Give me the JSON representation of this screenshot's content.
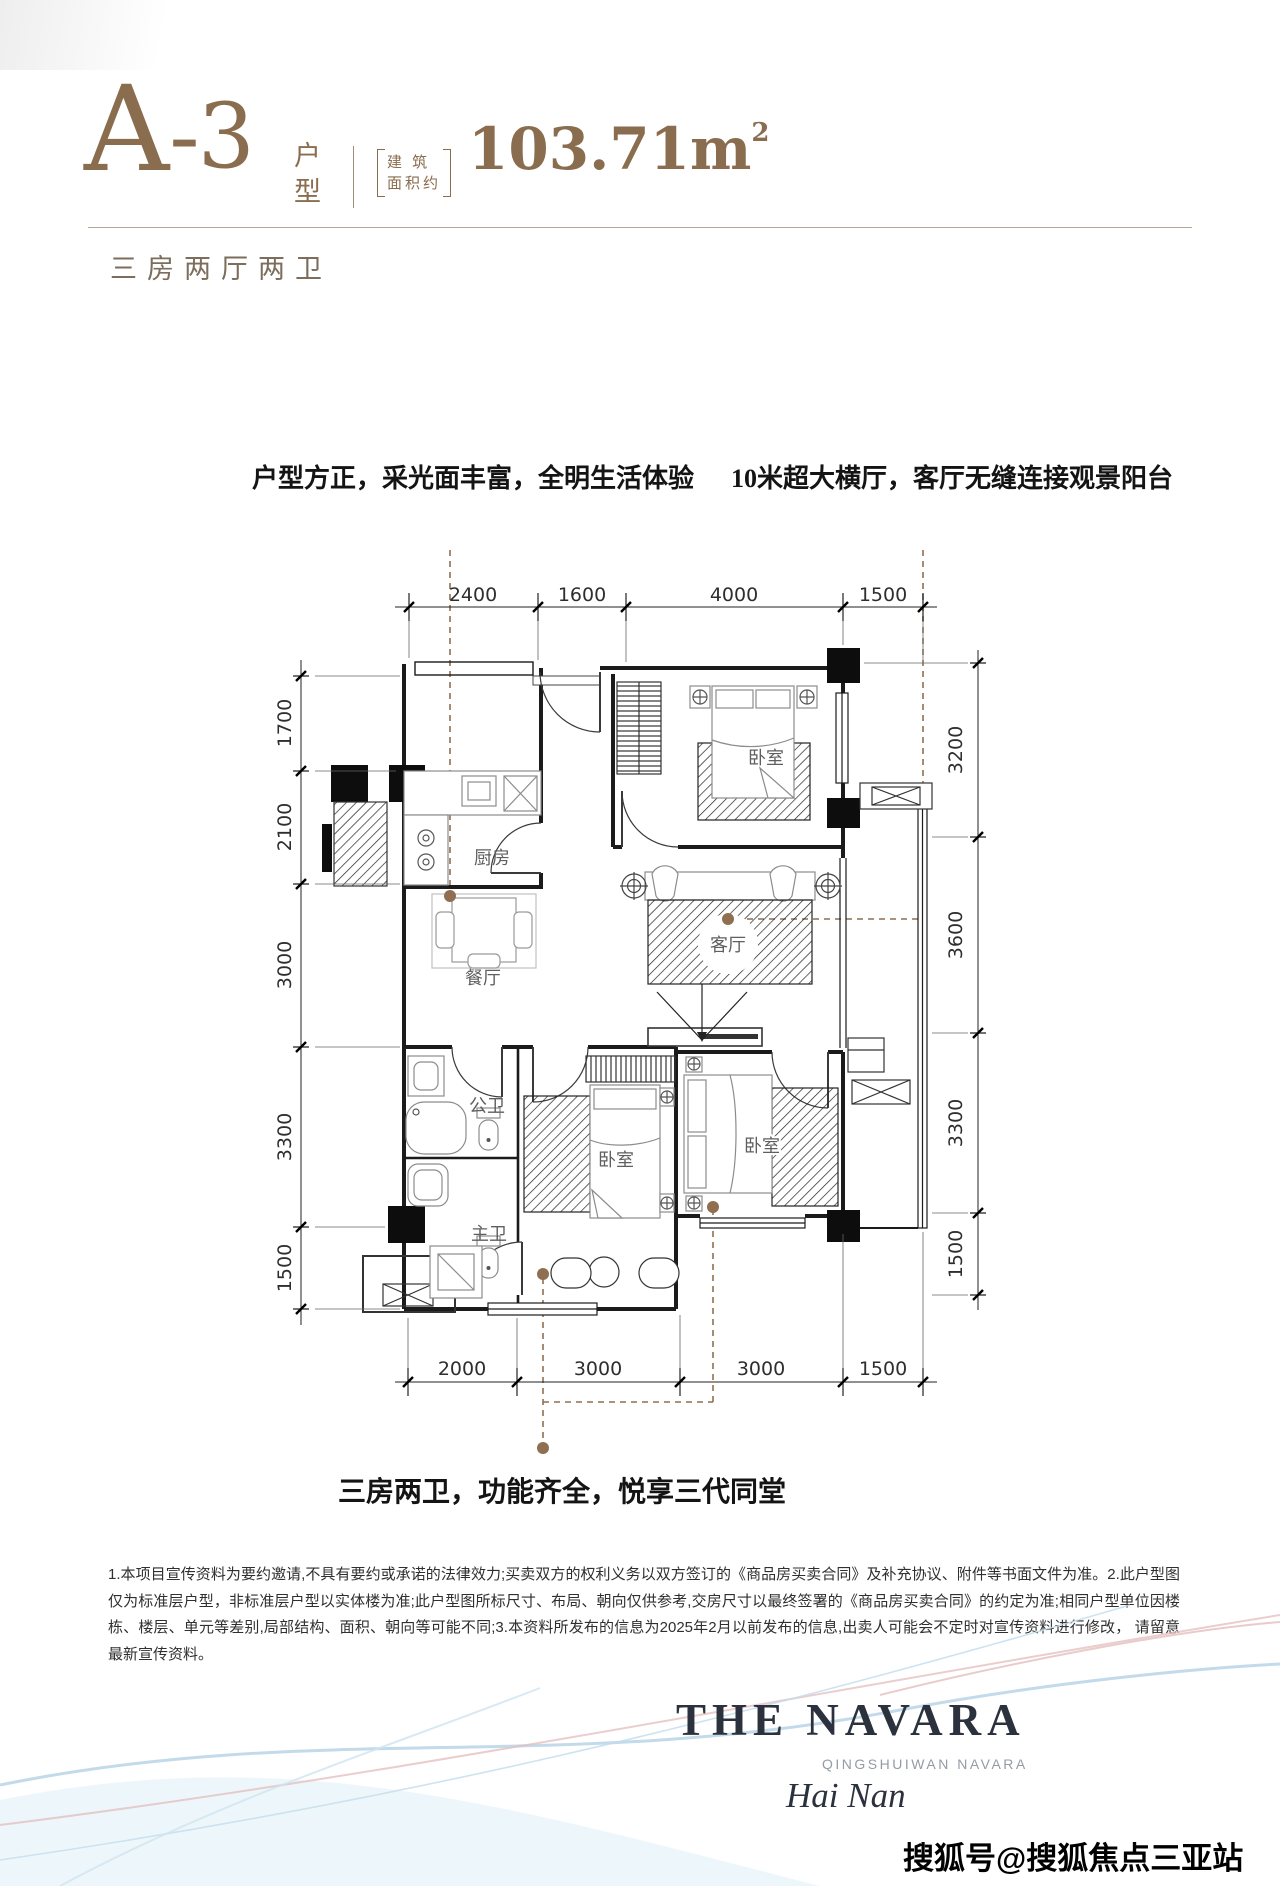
{
  "colors": {
    "accent": "#8a6d4e",
    "leader_brown": "#8f6f4f",
    "logo_navy": "#2b323d",
    "wave_blue": "#b9d4e6",
    "wave_pink": "#e3bcbc"
  },
  "header": {
    "unit_letter": "A",
    "unit_number": "-3",
    "type_top": "户",
    "type_bottom": "型",
    "area_label_line1": "建 筑",
    "area_label_line2": "面积约",
    "area_value": "103.71m",
    "area_sup": "2",
    "subtitle": "三房两厅两卫"
  },
  "annotations": {
    "left": "户型方正，采光面丰富，全明生活体验",
    "right": "10米超大横厅，客厅无缝连接观景阳台",
    "bottom": "三房两卫，功能齐全，悦享三代同堂"
  },
  "floorplan": {
    "labels": {
      "kitchen": "厨房",
      "dining": "餐厅",
      "bedroom_top": "卧室",
      "living": "客厅",
      "bath_public": "公卫",
      "bath_master": "主卫",
      "bedroom_mid": "卧室",
      "bedroom_right": "卧室"
    },
    "dims": {
      "top": [
        "2400",
        "1600",
        "4000",
        "1500"
      ],
      "left": [
        "1700",
        "2100",
        "3000",
        "3300",
        "1500"
      ],
      "right": [
        "3200",
        "3600",
        "3300",
        "1500"
      ],
      "bottom": [
        "2000",
        "3000",
        "3000",
        "1500"
      ]
    }
  },
  "disclaimer": {
    "text": "1.本项目宣传资料为要约邀请,不具有要约或承诺的法律效力;买卖双方的权利义务以双方签订的《商品房买卖合同》及补充协议、附件等书面文件为准。2.此户型图仅为标准层户型，非标准层户型以实体楼为准;此户型图所标尺寸、布局、朝向仅供参考,交房尺寸以最终签署的《商品房买卖合同》的约定为准;相同户型单位因楼栋、楼层、单元等差别,局部结构、面积、朝向等可能不同;3.本资料所发布的信息为2025年2月以前发布的信息,出卖人可能会不定时对宣传资料进行修改， 请留意最新宣传资料。"
  },
  "logo": {
    "title": "THE NAVARA",
    "subtitle": "QINGSHUIWAN NAVARA",
    "location": "Hai Nan"
  },
  "watermark": {
    "text": "搜狐号@搜狐焦点三亚站"
  }
}
